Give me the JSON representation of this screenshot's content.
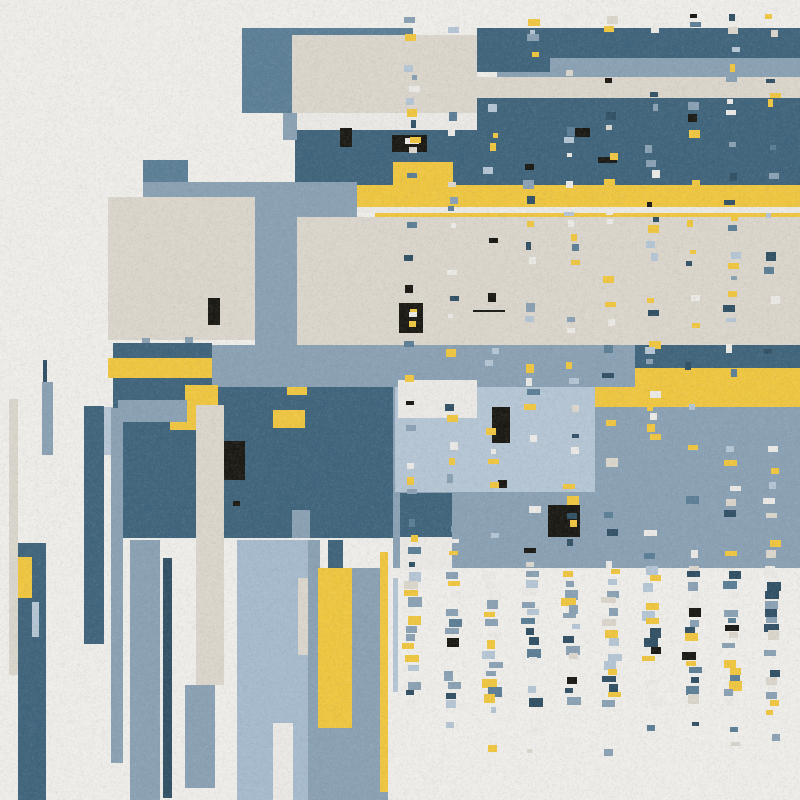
{
  "artwork": {
    "title": "abstract-rectangular-composition",
    "canvas": {
      "width": 800,
      "height": 800
    },
    "palette": {
      "bg": "#f1f0ec",
      "white": "#eeece8",
      "beige": "#ddd8ce",
      "yellow": "#f2c83e",
      "steel": "#5a7e96",
      "dark": "#3d637b",
      "navy": "#2f4f64",
      "slate": "#8aa2b5",
      "slateLight": "#b6c7d6",
      "slatePale": "#a7bccf",
      "black": "#17150f"
    },
    "shapes": [
      {
        "n": "steel-block-topleft",
        "x": 242,
        "y": 28,
        "w": 171,
        "h": 85,
        "c": "steel"
      },
      {
        "n": "beige-block-topleft",
        "x": 292,
        "y": 35,
        "w": 185,
        "h": 78,
        "c": "beige"
      },
      {
        "n": "white-strip-top",
        "x": 293,
        "y": 113,
        "w": 184,
        "h": 17,
        "c": "white"
      },
      {
        "n": "dark-band-a",
        "x": 477,
        "y": 28,
        "w": 323,
        "h": 30,
        "c": "dark"
      },
      {
        "n": "slate-band-top",
        "x": 497,
        "y": 58,
        "w": 303,
        "h": 19,
        "c": "slate"
      },
      {
        "n": "dark-tab-a",
        "x": 477,
        "y": 58,
        "w": 73,
        "h": 14,
        "c": "dark"
      },
      {
        "n": "beige-band",
        "x": 477,
        "y": 77,
        "w": 323,
        "h": 21,
        "c": "beige"
      },
      {
        "n": "dark-band-b",
        "x": 477,
        "y": 98,
        "w": 323,
        "h": 87,
        "c": "dark"
      },
      {
        "n": "dark-band-b-left",
        "x": 295,
        "y": 130,
        "w": 182,
        "h": 55,
        "c": "dark"
      },
      {
        "n": "black-bar-1",
        "x": 340,
        "y": 128,
        "w": 12,
        "h": 19,
        "c": "black"
      },
      {
        "n": "black-rect-q",
        "x": 392,
        "y": 135,
        "w": 35,
        "h": 17,
        "c": "black"
      },
      {
        "n": "white-dash-q",
        "x": 405,
        "y": 138,
        "w": 14,
        "h": 6,
        "c": "white"
      },
      {
        "n": "black-rect-r",
        "x": 575,
        "y": 128,
        "w": 15,
        "h": 9,
        "c": "black"
      },
      {
        "n": "black-dash-s",
        "x": 598,
        "y": 157,
        "w": 19,
        "h": 6,
        "c": "black"
      },
      {
        "n": "yellow-notch",
        "x": 393,
        "y": 162,
        "w": 60,
        "h": 23,
        "c": "yellow"
      },
      {
        "n": "yellow-band",
        "x": 357,
        "y": 185,
        "w": 443,
        "h": 22,
        "c": "yellow"
      },
      {
        "n": "white-gap-strip",
        "x": 357,
        "y": 207,
        "w": 443,
        "h": 6,
        "c": "white"
      },
      {
        "n": "yellow-strip-2",
        "x": 375,
        "y": 213,
        "w": 425,
        "h": 6,
        "c": "yellow"
      },
      {
        "n": "slate-band-d",
        "x": 143,
        "y": 182,
        "w": 214,
        "h": 35,
        "c": "slate"
      },
      {
        "n": "steel-rect-small",
        "x": 143,
        "y": 160,
        "w": 45,
        "h": 22,
        "c": "steel"
      },
      {
        "n": "beige-field",
        "x": 297,
        "y": 217,
        "w": 503,
        "h": 128,
        "c": "beige"
      },
      {
        "n": "beige-square",
        "x": 108,
        "y": 197,
        "w": 147,
        "h": 143,
        "c": "beige"
      },
      {
        "n": "slate-column",
        "x": 255,
        "y": 217,
        "w": 42,
        "h": 170,
        "c": "slate"
      },
      {
        "n": "slate-tab-a2",
        "x": 283,
        "y": 113,
        "w": 14,
        "h": 27,
        "c": "slate"
      },
      {
        "n": "black-rect-bs",
        "x": 208,
        "y": 298,
        "w": 12,
        "h": 27,
        "c": "black"
      },
      {
        "n": "black-square-p",
        "x": 399,
        "y": 303,
        "w": 24,
        "h": 30,
        "c": "black"
      },
      {
        "n": "yellow-dot-p1",
        "x": 410,
        "y": 309,
        "w": 7,
        "h": 6,
        "c": "yellow"
      },
      {
        "n": "yellow-dot-p2",
        "x": 409,
        "y": 321,
        "w": 7,
        "h": 6,
        "c": "yellow"
      },
      {
        "n": "hairline",
        "x": 473,
        "y": 310,
        "w": 32,
        "h": 2,
        "c": "black"
      },
      {
        "n": "slate-tab-b",
        "x": 142,
        "y": 338,
        "w": 8,
        "h": 7,
        "c": "slate"
      },
      {
        "n": "slate-tab-c",
        "x": 185,
        "y": 337,
        "w": 8,
        "h": 8,
        "c": "slate"
      },
      {
        "n": "dark-left-block",
        "x": 113,
        "y": 343,
        "w": 99,
        "h": 195,
        "c": "dark"
      },
      {
        "n": "yellow-band-left",
        "x": 108,
        "y": 358,
        "w": 104,
        "h": 20,
        "c": "yellow"
      },
      {
        "n": "slate-band-e",
        "x": 212,
        "y": 345,
        "w": 588,
        "h": 42,
        "c": "slate"
      },
      {
        "n": "dark-band-g",
        "x": 635,
        "y": 345,
        "w": 165,
        "h": 23,
        "c": "dark"
      },
      {
        "n": "yellow-h-upper",
        "x": 635,
        "y": 368,
        "w": 165,
        "h": 19,
        "c": "yellow"
      },
      {
        "n": "slate-field-i",
        "x": 393,
        "y": 387,
        "w": 407,
        "h": 181,
        "c": "slate"
      },
      {
        "n": "yellow-h-lower",
        "x": 595,
        "y": 387,
        "w": 205,
        "h": 20,
        "c": "yellow"
      },
      {
        "n": "slate-light-j",
        "x": 395,
        "y": 387,
        "w": 200,
        "h": 105,
        "c": "slateLight"
      },
      {
        "n": "white-rect-k",
        "x": 398,
        "y": 380,
        "w": 79,
        "h": 38,
        "c": "white"
      },
      {
        "n": "black-rect-j1",
        "x": 492,
        "y": 407,
        "w": 18,
        "h": 36,
        "c": "black"
      },
      {
        "n": "black-dot-j2",
        "x": 498,
        "y": 480,
        "w": 9,
        "h": 8,
        "c": "black"
      },
      {
        "n": "dark-rect-l",
        "x": 400,
        "y": 493,
        "w": 52,
        "h": 44,
        "c": "dark"
      },
      {
        "n": "white-rect-m",
        "x": 400,
        "y": 537,
        "w": 52,
        "h": 33,
        "c": "white"
      },
      {
        "n": "black-rect-n",
        "x": 548,
        "y": 505,
        "w": 32,
        "h": 32,
        "c": "black"
      },
      {
        "n": "yellow-dot-n",
        "x": 570,
        "y": 520,
        "w": 7,
        "h": 7,
        "c": "yellow"
      },
      {
        "n": "dark-field-f",
        "x": 120,
        "y": 387,
        "w": 273,
        "h": 151,
        "c": "dark"
      },
      {
        "n": "yellow-f1",
        "x": 185,
        "y": 385,
        "w": 33,
        "h": 27,
        "c": "yellow"
      },
      {
        "n": "yellow-f2",
        "x": 170,
        "y": 410,
        "w": 28,
        "h": 20,
        "c": "yellow"
      },
      {
        "n": "slate-f3",
        "x": 118,
        "y": 400,
        "w": 69,
        "h": 22,
        "c": "slate"
      },
      {
        "n": "yellow-f4",
        "x": 273,
        "y": 410,
        "w": 32,
        "h": 18,
        "c": "yellow"
      },
      {
        "n": "yellow-f5",
        "x": 287,
        "y": 387,
        "w": 20,
        "h": 8,
        "c": "yellow"
      },
      {
        "n": "black-rect-f6",
        "x": 223,
        "y": 441,
        "w": 22,
        "h": 39,
        "c": "black"
      },
      {
        "n": "black-dot-f7",
        "x": 233,
        "y": 501,
        "w": 7,
        "h": 5,
        "c": "black"
      },
      {
        "n": "slate-notch-f8",
        "x": 292,
        "y": 510,
        "w": 18,
        "h": 28,
        "c": "slate"
      },
      {
        "n": "beige-thin-bar",
        "x": 9,
        "y": 399,
        "w": 9,
        "h": 276,
        "c": "beige"
      },
      {
        "n": "navy-stick",
        "x": 43,
        "y": 360,
        "w": 4,
        "h": 24,
        "c": "navy"
      },
      {
        "n": "slate-bar-1",
        "x": 42,
        "y": 382,
        "w": 11,
        "h": 73,
        "c": "slate"
      },
      {
        "n": "dark-bar-1",
        "x": 18,
        "y": 543,
        "w": 28,
        "h": 257,
        "c": "dark"
      },
      {
        "n": "yellow-in-bar",
        "x": 18,
        "y": 557,
        "w": 14,
        "h": 41,
        "c": "yellow"
      },
      {
        "n": "slatelight-in-bar",
        "x": 32,
        "y": 602,
        "w": 7,
        "h": 35,
        "c": "slateLight"
      },
      {
        "n": "dark-bar-2",
        "x": 84,
        "y": 406,
        "w": 20,
        "h": 238,
        "c": "dark"
      },
      {
        "n": "slatelight-sliver",
        "x": 104,
        "y": 407,
        "w": 9,
        "h": 48,
        "c": "slateLight"
      },
      {
        "n": "slate-bar-3",
        "x": 111,
        "y": 408,
        "w": 12,
        "h": 355,
        "c": "slate"
      },
      {
        "n": "slate-bar-4",
        "x": 130,
        "y": 540,
        "w": 30,
        "h": 260,
        "c": "slate"
      },
      {
        "n": "navy-bar",
        "x": 163,
        "y": 558,
        "w": 9,
        "h": 240,
        "c": "navy"
      },
      {
        "n": "beige-column",
        "x": 196,
        "y": 405,
        "w": 28,
        "h": 280,
        "c": "beige"
      },
      {
        "n": "slate-stub",
        "x": 185,
        "y": 685,
        "w": 30,
        "h": 103,
        "c": "slate"
      },
      {
        "n": "slatepale-wide-bar",
        "x": 237,
        "y": 540,
        "w": 71,
        "h": 260,
        "c": "slatePale"
      },
      {
        "n": "beige-in-wide",
        "x": 298,
        "y": 578,
        "w": 10,
        "h": 77,
        "c": "beige"
      },
      {
        "n": "white-in-wide",
        "x": 273,
        "y": 723,
        "w": 20,
        "h": 77,
        "c": "white"
      },
      {
        "n": "slate-field-bottom-a",
        "x": 308,
        "y": 540,
        "w": 12,
        "h": 260,
        "c": "slate"
      },
      {
        "n": "slate-field-bottom-b",
        "x": 320,
        "y": 568,
        "w": 68,
        "h": 232,
        "c": "slate"
      },
      {
        "n": "dark-stub",
        "x": 328,
        "y": 540,
        "w": 15,
        "h": 28,
        "c": "dark"
      },
      {
        "n": "yellow-column",
        "x": 318,
        "y": 568,
        "w": 34,
        "h": 160,
        "c": "yellow"
      },
      {
        "n": "yellow-thin-bar",
        "x": 380,
        "y": 552,
        "w": 8,
        "h": 240,
        "c": "yellow"
      },
      {
        "n": "slatelight-sliver-2",
        "x": 393,
        "y": 578,
        "w": 5,
        "h": 114,
        "c": "slateLight"
      }
    ],
    "confetti": {
      "seed": 42,
      "columns": [
        412,
        452,
        492,
        532,
        572,
        612,
        652,
        692,
        732,
        772
      ],
      "x_jitter": 4,
      "colors": [
        "yellow",
        "white",
        "slate",
        "slateLight",
        "navy",
        "steel",
        "beige",
        "black"
      ],
      "weights": [
        0.22,
        0.15,
        0.17,
        0.13,
        0.14,
        0.08,
        0.07,
        0.04
      ],
      "zones": [
        {
          "y0": 13,
          "y1": 30,
          "step": 12,
          "p": 0.5,
          "wmin": 5,
          "wmax": 12,
          "hmin": 4,
          "hmax": 8
        },
        {
          "y0": 30,
          "y1": 98,
          "step": 15,
          "p": 0.3,
          "wmin": 5,
          "wmax": 12,
          "hmin": 4,
          "hmax": 8
        },
        {
          "y0": 98,
          "y1": 218,
          "step": 13,
          "p": 0.55,
          "wmin": 5,
          "wmax": 12,
          "hmin": 4,
          "hmax": 9
        },
        {
          "y0": 218,
          "y1": 345,
          "step": 14,
          "p": 0.5,
          "wmin": 5,
          "wmax": 12,
          "hmin": 4,
          "hmax": 9
        },
        {
          "y0": 345,
          "y1": 568,
          "step": 13,
          "p": 0.6,
          "wmin": 5,
          "wmax": 13,
          "hmin": 4,
          "hmax": 9
        },
        {
          "y0": 568,
          "y1": 706,
          "step": 9,
          "p": 0.85,
          "wmin": 8,
          "wmax": 15,
          "hmin": 5,
          "hmax": 10
        },
        {
          "y0": 706,
          "y1": 726,
          "step": 12,
          "p": 0.3,
          "wmin": 5,
          "wmax": 9,
          "hmin": 4,
          "hmax": 6
        },
        {
          "y0": 726,
          "y1": 762,
          "step": 17,
          "p": 0.35,
          "wmin": 5,
          "wmax": 10,
          "hmin": 4,
          "hmax": 7
        }
      ]
    },
    "noise": {
      "seed": 49,
      "alpha_max": 36
    }
  }
}
